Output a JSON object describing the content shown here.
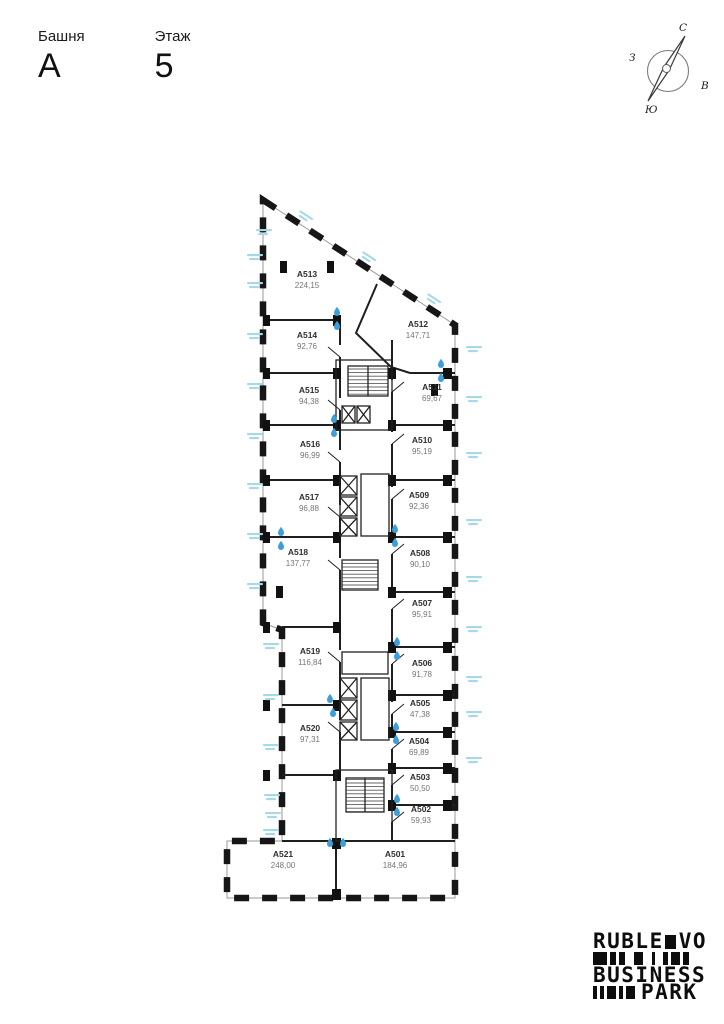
{
  "header": {
    "tower_label": "Башня",
    "tower_value": "A",
    "floor_label": "Этаж",
    "floor_value": "5"
  },
  "compass": {
    "north": "С",
    "south": "Ю",
    "west": "З",
    "east": "В"
  },
  "colors": {
    "wall": "#1a1a1a",
    "unit_id_text": "#2f2f2f",
    "unit_area_text": "#757575",
    "water_drop_blue": "#3e9fd8",
    "facade_annotation_cyan": "#a6d9e8"
  },
  "plan": {
    "units": [
      {
        "id": "A501",
        "area": "184,96",
        "x": 395,
        "y": 857
      },
      {
        "id": "A502",
        "area": "59,93",
        "x": 421,
        "y": 812
      },
      {
        "id": "A503",
        "area": "50,50",
        "x": 420,
        "y": 780
      },
      {
        "id": "A504",
        "area": "69,89",
        "x": 419,
        "y": 744
      },
      {
        "id": "A505",
        "area": "47,38",
        "x": 420,
        "y": 706
      },
      {
        "id": "A506",
        "area": "91,78",
        "x": 422,
        "y": 666
      },
      {
        "id": "A507",
        "area": "95,91",
        "x": 422,
        "y": 606
      },
      {
        "id": "A508",
        "area": "90,10",
        "x": 420,
        "y": 556
      },
      {
        "id": "A509",
        "area": "92,36",
        "x": 419,
        "y": 498
      },
      {
        "id": "A510",
        "area": "95,19",
        "x": 422,
        "y": 443
      },
      {
        "id": "A511",
        "area": "69,67",
        "x": 432,
        "y": 390
      },
      {
        "id": "A512",
        "area": "147,71",
        "x": 418,
        "y": 327
      },
      {
        "id": "A513",
        "area": "224,15",
        "x": 307,
        "y": 277
      },
      {
        "id": "A514",
        "area": "92,76",
        "x": 307,
        "y": 338
      },
      {
        "id": "A515",
        "area": "94,38",
        "x": 309,
        "y": 393
      },
      {
        "id": "A516",
        "area": "96,99",
        "x": 310,
        "y": 447
      },
      {
        "id": "A517",
        "area": "96,88",
        "x": 309,
        "y": 500
      },
      {
        "id": "A518",
        "area": "137,77",
        "x": 298,
        "y": 555
      },
      {
        "id": "A519",
        "area": "116,84",
        "x": 310,
        "y": 654
      },
      {
        "id": "A520",
        "area": "97,31",
        "x": 310,
        "y": 731
      },
      {
        "id": "A521",
        "area": "248,00",
        "x": 283,
        "y": 857
      }
    ],
    "water_drops": [
      [
        337,
        311
      ],
      [
        337,
        325
      ],
      [
        441,
        363
      ],
      [
        441,
        377
      ],
      [
        334,
        418
      ],
      [
        334,
        432
      ],
      [
        281,
        531
      ],
      [
        281,
        545
      ],
      [
        395,
        528
      ],
      [
        395,
        542
      ],
      [
        397,
        641
      ],
      [
        397,
        655
      ],
      [
        330,
        698
      ],
      [
        333,
        712
      ],
      [
        396,
        726
      ],
      [
        396,
        739
      ],
      [
        397,
        798
      ],
      [
        397,
        811
      ],
      [
        330,
        842
      ],
      [
        343,
        842
      ]
    ],
    "facade_annotations": [
      [
        247,
        254,
        0
      ],
      [
        247,
        282,
        0
      ],
      [
        247,
        333,
        0
      ],
      [
        247,
        383,
        0
      ],
      [
        247,
        433,
        0
      ],
      [
        247,
        483,
        0
      ],
      [
        247,
        533,
        0
      ],
      [
        247,
        583,
        0
      ],
      [
        263,
        643,
        0
      ],
      [
        263,
        694,
        0
      ],
      [
        263,
        744,
        0
      ],
      [
        264,
        794,
        0
      ],
      [
        265,
        812,
        0
      ],
      [
        263,
        829,
        0
      ],
      [
        300,
        210,
        33
      ],
      [
        363,
        251,
        33
      ],
      [
        428,
        293,
        33
      ],
      [
        256,
        229,
        0
      ],
      [
        466,
        346,
        0
      ],
      [
        466,
        396,
        0
      ],
      [
        466,
        452,
        0
      ],
      [
        466,
        519,
        0
      ],
      [
        466,
        576,
        0
      ],
      [
        466,
        626,
        0
      ],
      [
        466,
        676,
        0
      ],
      [
        466,
        711,
        0
      ],
      [
        466,
        757,
        0
      ]
    ]
  },
  "logo": {
    "word1": "RUBLE",
    "word2": "VO",
    "word3": "BUSINESS",
    "word4": "PARK",
    "barcode_top": [
      [
        14,
        3
      ],
      [
        6,
        3
      ],
      [
        6,
        9
      ],
      [
        9,
        9
      ],
      [
        3,
        8
      ],
      [
        5,
        3
      ],
      [
        9,
        3
      ],
      [
        6,
        0
      ]
    ],
    "barcode_bottom": [
      [
        4,
        3
      ],
      [
        4,
        3
      ],
      [
        9,
        3
      ],
      [
        4,
        3
      ],
      [
        9,
        0
      ]
    ]
  }
}
